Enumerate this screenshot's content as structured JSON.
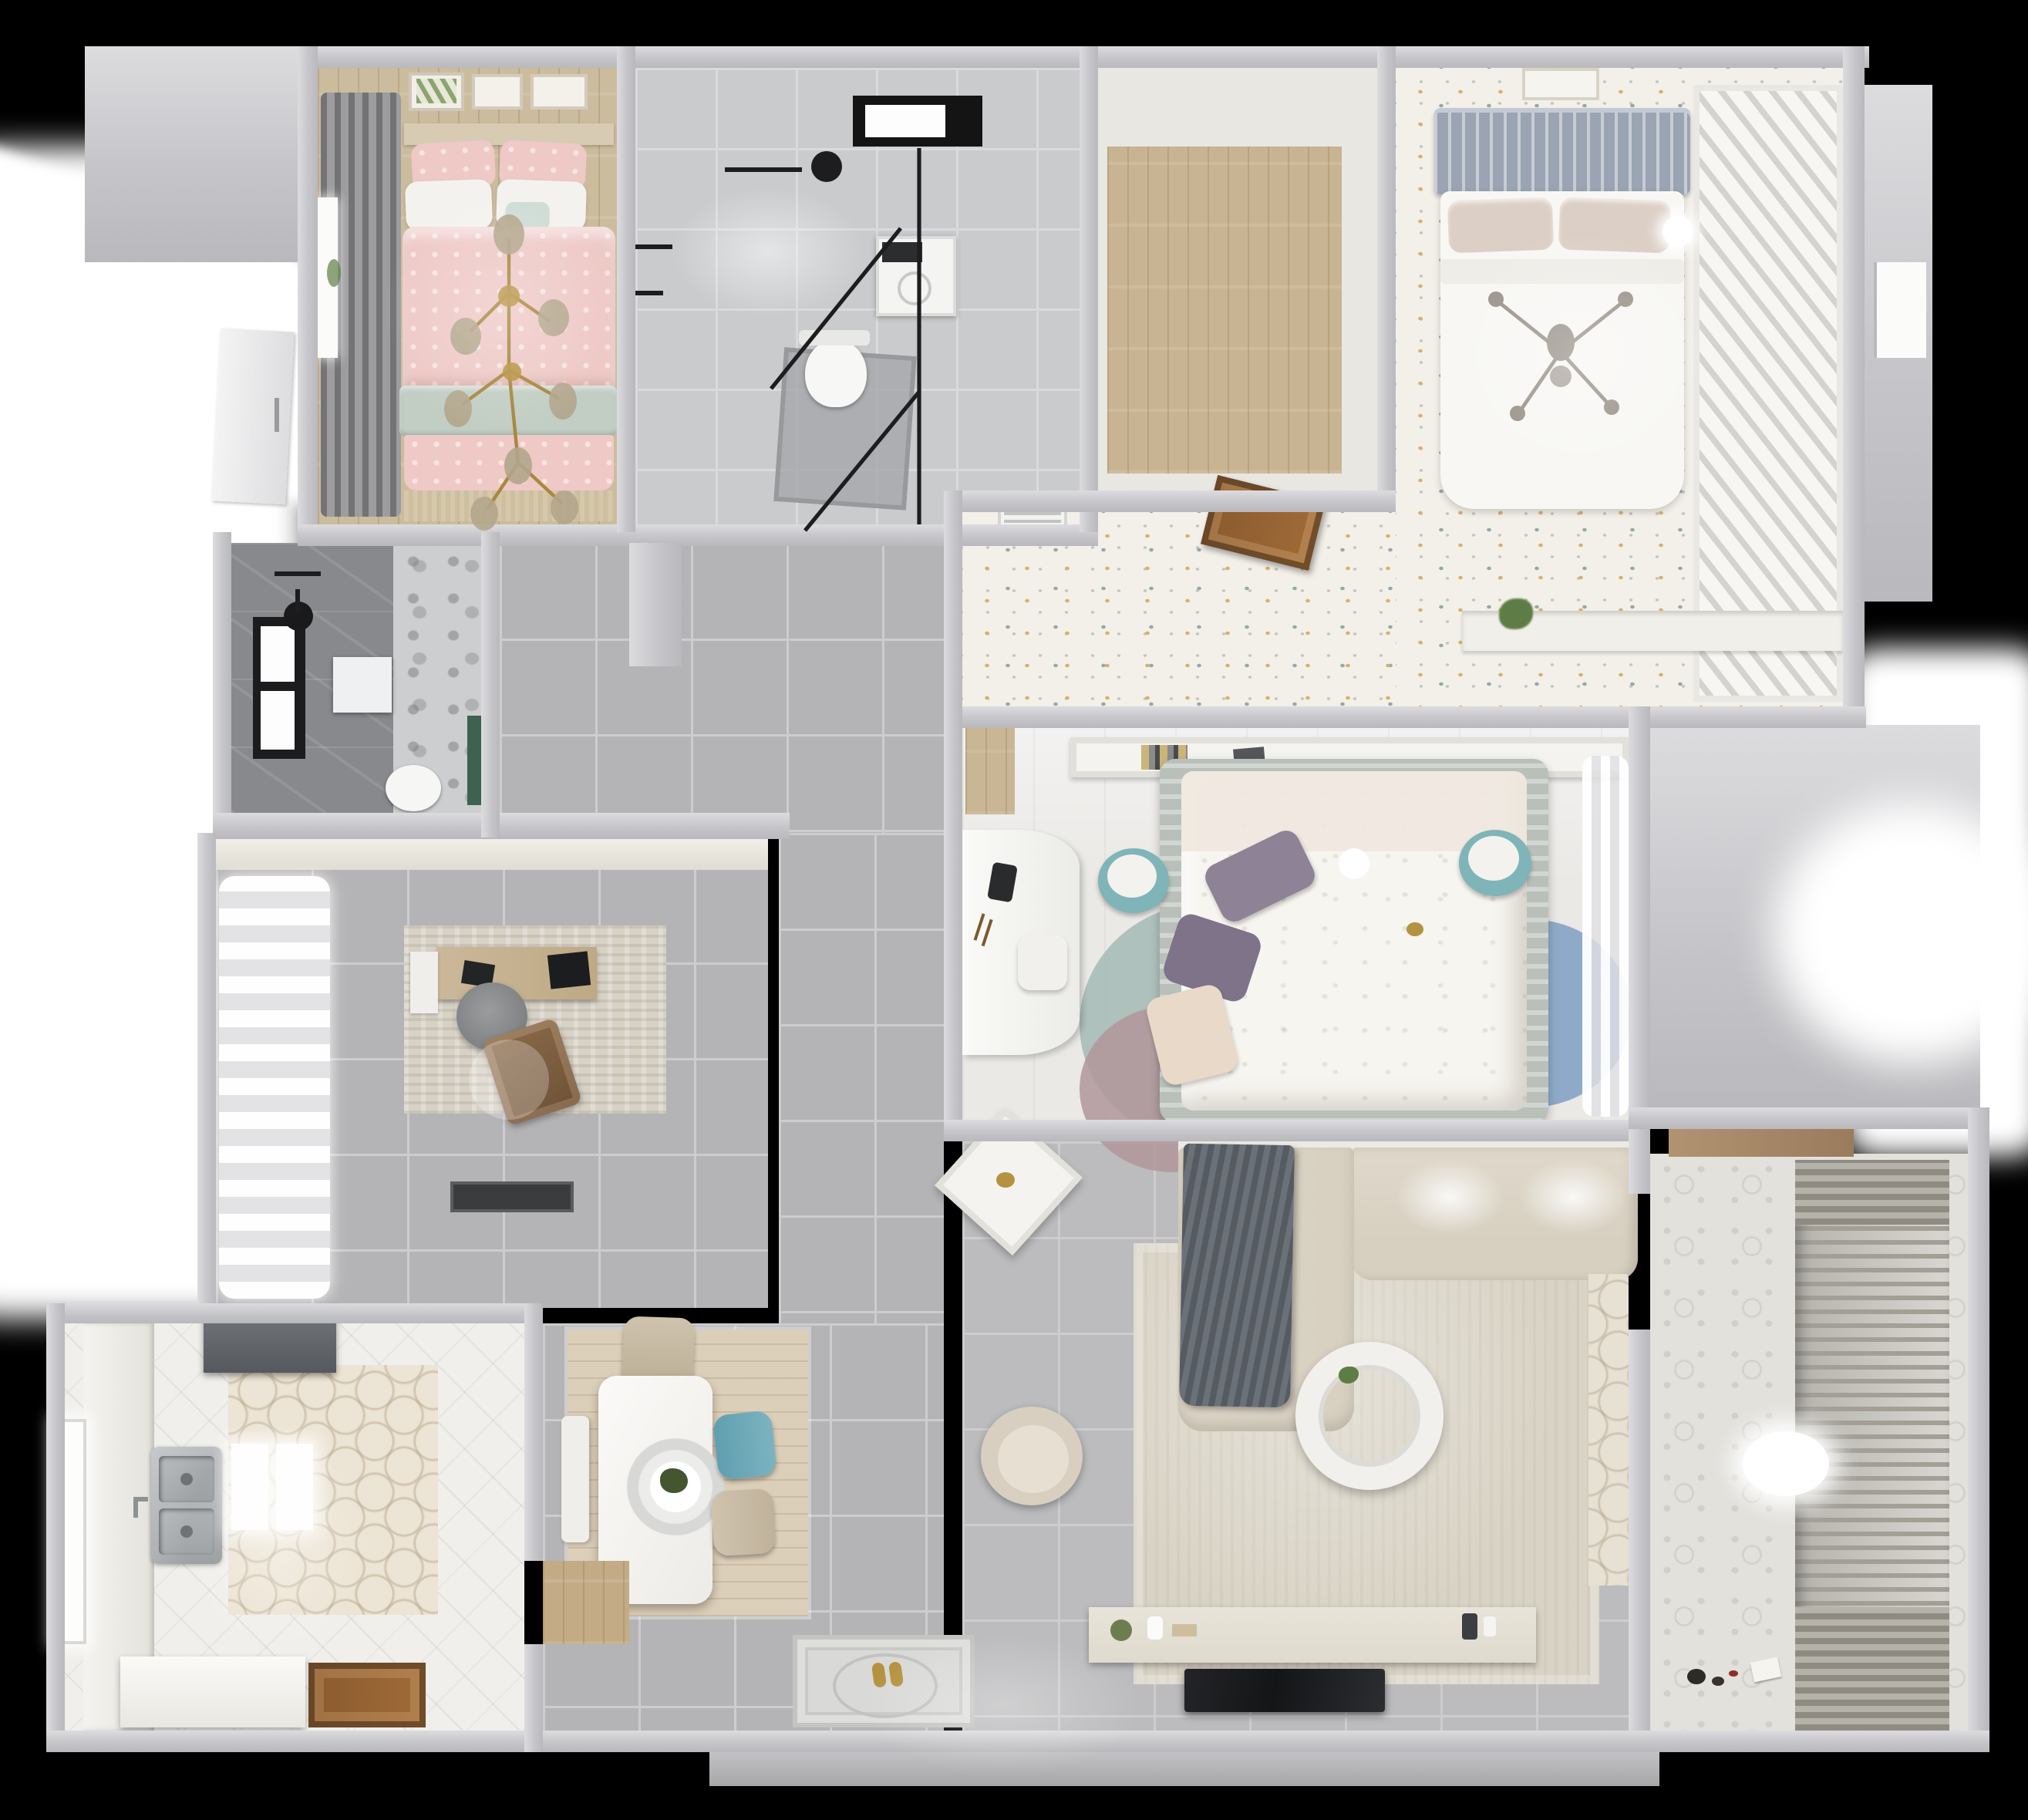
{
  "scene": {
    "title": "Top-down 3D rendered apartment floor plan",
    "view": "orthographic top view",
    "visible_text": "none"
  },
  "colors": {
    "bg": "#000000",
    "exterior": "#ffffff",
    "wall": "#c6c6ca",
    "wallhi": "#dcdcdf",
    "tile": "#b4b4b6",
    "grout": "#cdcdcf",
    "wood": "#ccbc9e",
    "wooddoor": "#8a5a2e",
    "kidfloor": "#f3f0e9",
    "dotgold": "#d5b269",
    "dotteal": "#93a9ac",
    "pink": "#eec9c6",
    "sage": "#c2cec4",
    "headboard": "#9aa4b3",
    "purple": "#8e8296",
    "cream": "#e8d9c8",
    "tealpouf": "#7fb4b8",
    "tealchair": "#5f9fb0",
    "bathdark": "#87898d",
    "marble": "#c9cbcd",
    "green": "#3f6150",
    "plant": "#5e7d46",
    "sofa": "#d7d0c1",
    "rug": "#d9d3c5",
    "blanket": "#5b6067",
    "console": "#dfdacd",
    "tv": "#141517",
    "gold": "#b5923f",
    "steel": "#aeb2b5",
    "balcony": "#e2e1dc",
    "rack": "#a39f97"
  },
  "rooms": [
    {
      "id": "master-bedroom",
      "label": "Master bedroom",
      "floor": "light wood",
      "furniture": [
        "double bed with pink bedding",
        "sage throw band",
        "gold branch chandelier",
        "dark curtains",
        "three framed wall prints",
        "window with plant"
      ]
    },
    {
      "id": "main-bathroom",
      "label": "Bathroom",
      "floor": "grey marble tile",
      "furniture": [
        "glass walk-in shower",
        "black shower head",
        "washing machine",
        "toilet",
        "black framed window"
      ]
    },
    {
      "id": "storage-closet",
      "label": "Closet",
      "floor": "wood planks",
      "furniture": []
    },
    {
      "id": "kids-bedroom",
      "label": "Kids bedroom",
      "floor": "confetti-dot carpet",
      "furniture": [
        "bed with slatted blue-grey headboard",
        "white duvet",
        "cross chandelier",
        "slatted wardrobe doors",
        "wall shelf with plant",
        "framed print",
        "open wood door",
        "air vent"
      ]
    },
    {
      "id": "ensuite-shower-room",
      "label": "Shower room",
      "floor": "dark grey tile with marble mosaic",
      "furniture": [
        "black shower head",
        "shower tray",
        "toilet",
        "black framed window",
        "green vanity strip"
      ]
    },
    {
      "id": "study",
      "label": "Study",
      "floor": "grey tile",
      "furniture": [
        "wood desk",
        "grey round desk chair",
        "brown lounge chair",
        "textured rug",
        "billowy white curtains",
        "dark doormat"
      ]
    },
    {
      "id": "middle-bedroom",
      "label": "Bedroom",
      "floor": "pale wood",
      "furniture": [
        "double bed with floral duvet",
        "purple pillows",
        "headboard shelf with books",
        "two teal poufs",
        "white desk",
        "overlapping circle rug",
        "sheer curtains"
      ]
    },
    {
      "id": "living-room",
      "label": "Living room",
      "floor": "grey tile",
      "furniture": [
        "L-shaped beige sofa",
        "dark grey throw blanket",
        "round nesting coffee table",
        "beige armchair",
        "white side table",
        "TV console with decor",
        "wall TV",
        "large beige rug"
      ]
    },
    {
      "id": "dining-area",
      "label": "Dining area",
      "floor": "wood rug over grey tile",
      "furniture": [
        "white dining table",
        "ring pendant lamp with plant",
        "beige chair",
        "teal chair",
        "white bench"
      ]
    },
    {
      "id": "kitchen",
      "label": "Kitchen",
      "floor": "hexagon tile and white tile",
      "furniture": [
        "range hood",
        "double stainless sink",
        "white counters",
        "lit worktops",
        "island",
        "wood door",
        "tall window"
      ]
    },
    {
      "id": "hallway",
      "label": "Hallway",
      "floor": "grey tile",
      "furniture": [
        "ornate entry mat",
        "gold slippers",
        "wood threshold",
        "white entry door"
      ]
    },
    {
      "id": "balcony",
      "label": "Balcony / laundry",
      "floor": "patterned tile",
      "furniture": [
        "drying rack blinds",
        "oval ceiling light",
        "toys on floor",
        "wood shelf"
      ]
    }
  ]
}
